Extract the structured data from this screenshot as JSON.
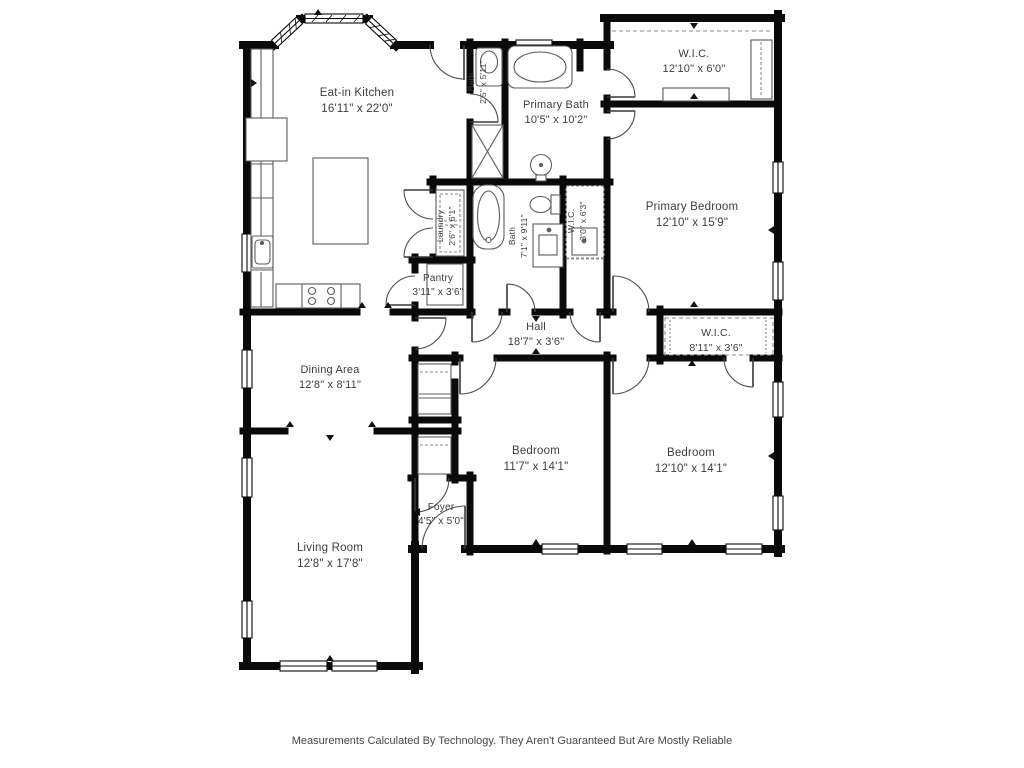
{
  "page": {
    "background": "#ffffff"
  },
  "palette": {
    "wall": "#0a0a0a",
    "label_text": "#3d3d3d",
    "fixture_line": "#5c5c5c",
    "door_arc": "#4d4d4d",
    "dash_line": "#8a8a8a"
  },
  "footer": {
    "disclaimer": "Measurements Calculated By Technology. They Aren't Guaranteed But Are Mostly Reliable"
  },
  "rooms": [
    {
      "id": "eat-in-kitchen",
      "name": "Eat-in Kitchen",
      "dims": "16'11\" x 22'0\"",
      "x": 357,
      "y": 96,
      "size": 11.5,
      "rotated": false
    },
    {
      "id": "wic-primary",
      "name": "W.I.C.",
      "dims": "12'10\" x 6'0\"",
      "x": 694,
      "y": 57,
      "size": 11,
      "rotated": false
    },
    {
      "id": "primary-bath",
      "name": "Primary Bath",
      "dims": "10'5\" x 10'2\"",
      "x": 556,
      "y": 108,
      "size": 11,
      "rotated": false
    },
    {
      "id": "bath-small",
      "name": "Bath",
      "dims": "2'5\" x 5'11\"",
      "x": 474,
      "y": 82,
      "size": 8.5,
      "rotated": true
    },
    {
      "id": "primary-bedroom",
      "name": "Primary Bedroom",
      "dims": "12'10\" x 15'9\"",
      "x": 692,
      "y": 210,
      "size": 11.5,
      "rotated": false
    },
    {
      "id": "laundry",
      "name": "Laundry",
      "dims": "2'6\" x 6'1\"",
      "x": 443,
      "y": 226,
      "size": 8.5,
      "rotated": true
    },
    {
      "id": "bath",
      "name": "Bath",
      "dims": "7'1\" x 9'11\"",
      "x": 515,
      "y": 236,
      "size": 8.5,
      "rotated": true
    },
    {
      "id": "wic-hall",
      "name": "W.I.C.",
      "dims": "3'0\" x 6'3\"",
      "x": 574,
      "y": 221,
      "size": 8.5,
      "rotated": true
    },
    {
      "id": "pantry",
      "name": "Pantry",
      "dims": "3'11\" x 3'6\"",
      "x": 438,
      "y": 281,
      "size": 10,
      "rotated": false
    },
    {
      "id": "hall",
      "name": "Hall",
      "dims": "18'7\" x 3'6\"",
      "x": 536,
      "y": 330,
      "size": 11,
      "rotated": false
    },
    {
      "id": "wic-bedroom",
      "name": "W.I.C.",
      "dims": "8'11\" x 3'6\"",
      "x": 716,
      "y": 336,
      "size": 10.5,
      "rotated": false
    },
    {
      "id": "dining-area",
      "name": "Dining Area",
      "dims": "12'8\" x 8'11\"",
      "x": 330,
      "y": 373,
      "size": 11,
      "rotated": false
    },
    {
      "id": "bedroom-1",
      "name": "Bedroom",
      "dims": "11'7\" x 14'1\"",
      "x": 536,
      "y": 454,
      "size": 11.5,
      "rotated": false
    },
    {
      "id": "bedroom-2",
      "name": "Bedroom",
      "dims": "12'10\" x 14'1\"",
      "x": 691,
      "y": 456,
      "size": 11.5,
      "rotated": false
    },
    {
      "id": "foyer",
      "name": "Foyer",
      "dims": "4'5\" x 5'0\"",
      "x": 441,
      "y": 510,
      "size": 10,
      "rotated": false
    },
    {
      "id": "living-room",
      "name": "Living Room",
      "dims": "12'8\" x 17'8\"",
      "x": 330,
      "y": 551,
      "size": 11.5,
      "rotated": false
    }
  ]
}
